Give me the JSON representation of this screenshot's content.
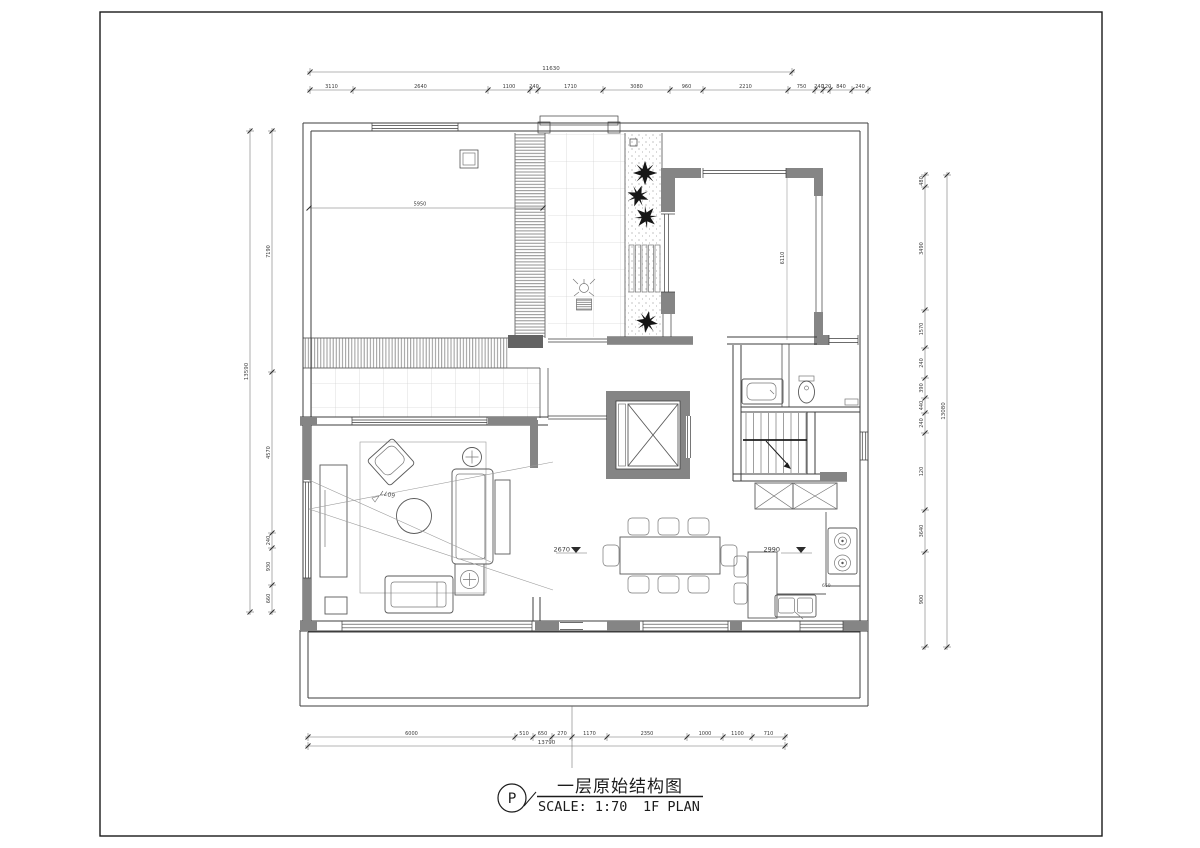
{
  "sheet": {
    "title": "一层原始结构图",
    "scale_label": "SCALE: 1:70",
    "plan_label": "1F PLAN",
    "marker": "P"
  },
  "annotations": {
    "room_width": "5950",
    "room_height": "6110",
    "living_diag": "6077",
    "dining_level": "2670",
    "kitchen_level": "2990",
    "counter_depth": "650"
  },
  "dimensions": {
    "top_total": {
      "labels": [
        "11630"
      ]
    },
    "top": {
      "labels": [
        "3110",
        "2640",
        "1100",
        "240",
        "1710",
        "3080",
        "960",
        "2210",
        "750",
        "240",
        "120",
        "840",
        "240"
      ]
    },
    "left_total": {
      "labels": [
        "13590"
      ]
    },
    "left": {
      "labels": [
        "7190",
        "4570",
        "240",
        "930",
        "660"
      ]
    },
    "right_total": {
      "labels": [
        "13080"
      ]
    },
    "right": {
      "labels": [
        "480",
        "3490",
        "1570",
        "240",
        "390",
        "440",
        "240",
        "120",
        "3640",
        "900"
      ]
    },
    "bottom_total": {
      "labels": [
        "13790"
      ]
    },
    "bottom": {
      "labels": [
        "6000",
        "510",
        "650",
        "270",
        "1170",
        "2350",
        "1000",
        "1100",
        "710"
      ]
    }
  },
  "colors": {
    "wall_fill": "#858585",
    "wall_dark": "#636363",
    "line": "#3d3d3d",
    "plant": "#161616"
  }
}
